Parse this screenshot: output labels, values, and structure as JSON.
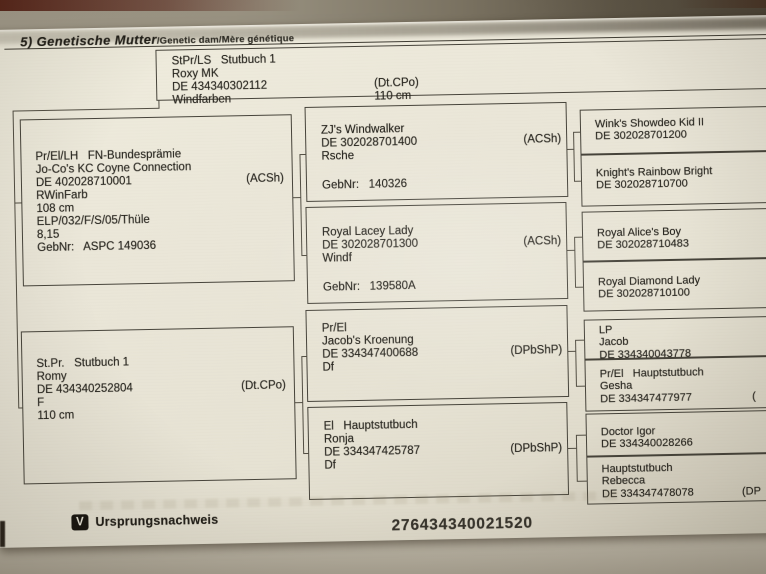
{
  "header": {
    "section": "5) Genetische Mutter",
    "translation": "/Genetic dam/Mère génétique"
  },
  "boxes": {
    "dam": {
      "lines": [
        "StPr/LS   Stutbuch 1",
        "Roxy MK",
        "DE 434340302112",
        "Windfarben"
      ],
      "breed": "(Dt.CPo)",
      "height": "110 cm"
    },
    "dam_sire": {
      "lines": [
        "Pr/El/LH   FN-Bundesprämie",
        "Jo-Co's KC Coyne Connection",
        "DE 402028710001",
        "RWinFarb",
        "108 cm",
        "ELP/032/F/S/05/Thüle",
        "8,15",
        "GebNr:   ASPC 149036"
      ],
      "breed": "(ACSh)"
    },
    "dam_dam": {
      "lines": [
        "St.Pr.   Stutbuch 1",
        "Romy",
        "DE 434340252804",
        "F",
        "110 cm"
      ],
      "breed": "(Dt.CPo)"
    },
    "g3_1": {
      "lines": [
        "ZJ's Windwalker",
        "DE 302028701400",
        "Rsche"
      ],
      "breed": "(ACSh)",
      "gebnr": "GebNr:   140326"
    },
    "g3_2": {
      "lines": [
        "Royal Lacey Lady",
        "DE 302028701300",
        "Windf"
      ],
      "breed": "(ACSh)",
      "gebnr": "GebNr:   139580A"
    },
    "g3_3": {
      "lines": [
        "Pr/El",
        "Jacob's Kroenung",
        "DE 334347400688",
        "Df"
      ],
      "breed": "(DPbShP)"
    },
    "g3_4": {
      "lines": [
        "El   Hauptstutbuch",
        "Ronja",
        "DE 334347425787",
        "Df"
      ],
      "breed": "(DPbShP)"
    },
    "g4_1": {
      "lines": [
        "Wink's Showdeo Kid II",
        "DE 302028701200"
      ]
    },
    "g4_2": {
      "lines": [
        "Knight's Rainbow Bright",
        "DE 302028710700"
      ]
    },
    "g4_3": {
      "lines": [
        "Royal Alice's Boy",
        "DE 302028710483"
      ]
    },
    "g4_4": {
      "lines": [
        "Royal Diamond Lady",
        "DE 302028710100"
      ]
    },
    "g4_5": {
      "lines": [
        "LP",
        "Jacob",
        "DE 334340043778"
      ]
    },
    "g4_6": {
      "lines": [
        "Pr/El   Hauptstutbuch",
        "Gesha",
        "DE 334347477977"
      ],
      "breed": "("
    },
    "g4_7": {
      "lines": [
        "Doctor Igor",
        "DE 334340028266"
      ]
    },
    "g4_8": {
      "lines": [
        "Hauptstutbuch",
        "Rebecca",
        "DE 334347478078"
      ],
      "breed": "(DP"
    }
  },
  "footer": {
    "badge": "V",
    "label": "Ursprungsnachweis",
    "document_number": "276434340021520"
  }
}
